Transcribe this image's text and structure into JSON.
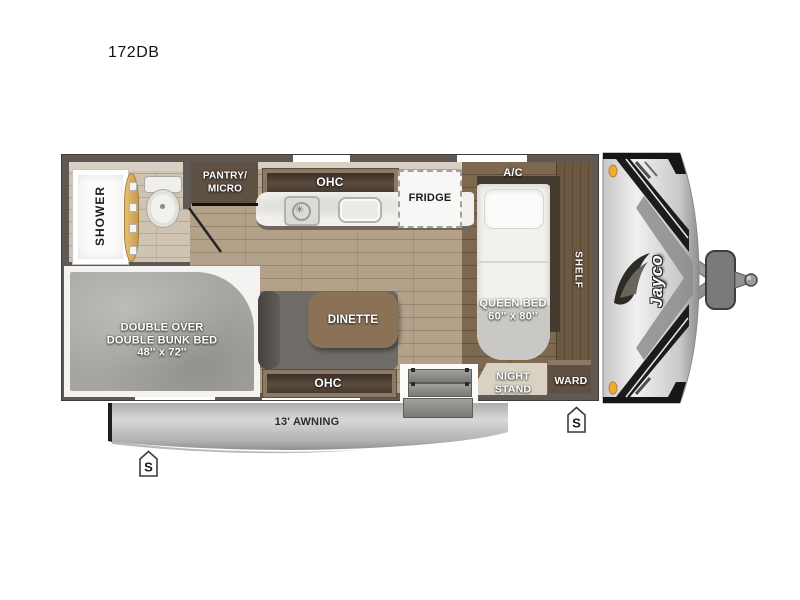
{
  "title": "172DB",
  "labels": {
    "shower": "SHOWER",
    "pantry_line1": "PANTRY/",
    "pantry_line2": "MICRO",
    "kitchen_ohc": "OHC",
    "fridge": "FRIDGE",
    "ac": "A/C",
    "queen_bed_line1": "QUEEN BED",
    "queen_bed_line2": "60'' x 80''",
    "shelf": "SHELF",
    "ward": "WARD",
    "night_stand_line1": "NIGHT",
    "night_stand_line2": "STAND",
    "dinette": "DINETTE",
    "dinette_ohc": "OHC",
    "bunk_line1": "DOUBLE OVER",
    "bunk_line2": "DOUBLE BUNK BED",
    "bunk_line3": "48'' x 72''",
    "awning": "13' AWNING"
  },
  "markers": {
    "stabilizer_front": "S",
    "stabilizer_rear": "S"
  },
  "brand": {
    "logo_text": "Jayco"
  },
  "colors": {
    "wall": "#5f5853",
    "floor_main": "#b3a18a",
    "floor_bath": "#cfc4b1",
    "floor_bedroom": "#7d6850",
    "cabinet_dark": "#5e5043",
    "counter": "#f2f0ec",
    "awning_gray": "#b5b5b5",
    "clearance_light_amber": "#f2a93b",
    "shower_door_tan": "#d9b269"
  }
}
